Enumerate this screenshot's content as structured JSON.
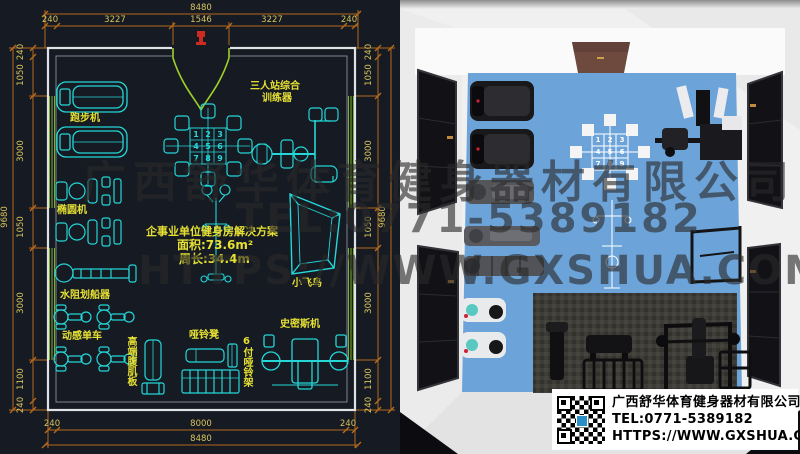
{
  "plan": {
    "dims": {
      "top_total": "8480",
      "top": [
        "240",
        "3227",
        "1546",
        "3227",
        "240"
      ],
      "bottom": [
        "240",
        "8000",
        "240"
      ],
      "bottom_total": "8480",
      "side_total": "9680",
      "left": [
        "240",
        "1050",
        "3000",
        "1050",
        "3000",
        "1100",
        "240"
      ],
      "right": [
        "240",
        "1050",
        "3000",
        "1050",
        "3000",
        "1100",
        "240"
      ]
    },
    "labels": {
      "treadmill": "跑步机",
      "elliptical": "椭圆机",
      "rower": "水阻划船器",
      "spin_bike": "动感单车",
      "ab_board": "高端腹肌板",
      "dumbbell_bench": "哑铃凳",
      "dumbbell_rack": "6付哑铃架",
      "smith": "史密斯机",
      "fly": "小飞鸟",
      "trainer_line1": "三人站综合",
      "trainer_line2": "训练器"
    },
    "solution": {
      "title": "企事业单位健身房解决方案",
      "area": "面积:73.6m²",
      "perimeter": "周长:34.4m"
    },
    "station_numbers": [
      "1",
      "2",
      "3",
      "4",
      "5",
      "6",
      "7",
      "8",
      "9"
    ]
  },
  "watermark": {
    "company": "广西舒华体育健身器材有限公司",
    "tel": "TEL:0771-5389182",
    "url": "HTTPS://WWW.GXSHUA.COM"
  },
  "info_box": {
    "company": "广西舒华体育健身器材有限公司",
    "tel": "TEL:0771-5389182",
    "url": "HTTPS://WWW.GXSHUA.COM"
  },
  "colors": {
    "plan_bg": "#151a23",
    "equipment_cyan": "#25d7d7",
    "label_yellow": "#e6e033",
    "dimension_orange": "#b36a1d",
    "dimension_text": "#d9c45d",
    "floor_blue": "#6ca4d9",
    "mat_gray": "#3c3a36",
    "wall_gray": "#f0f0f0",
    "sign_brown": "#6d4a3d"
  }
}
